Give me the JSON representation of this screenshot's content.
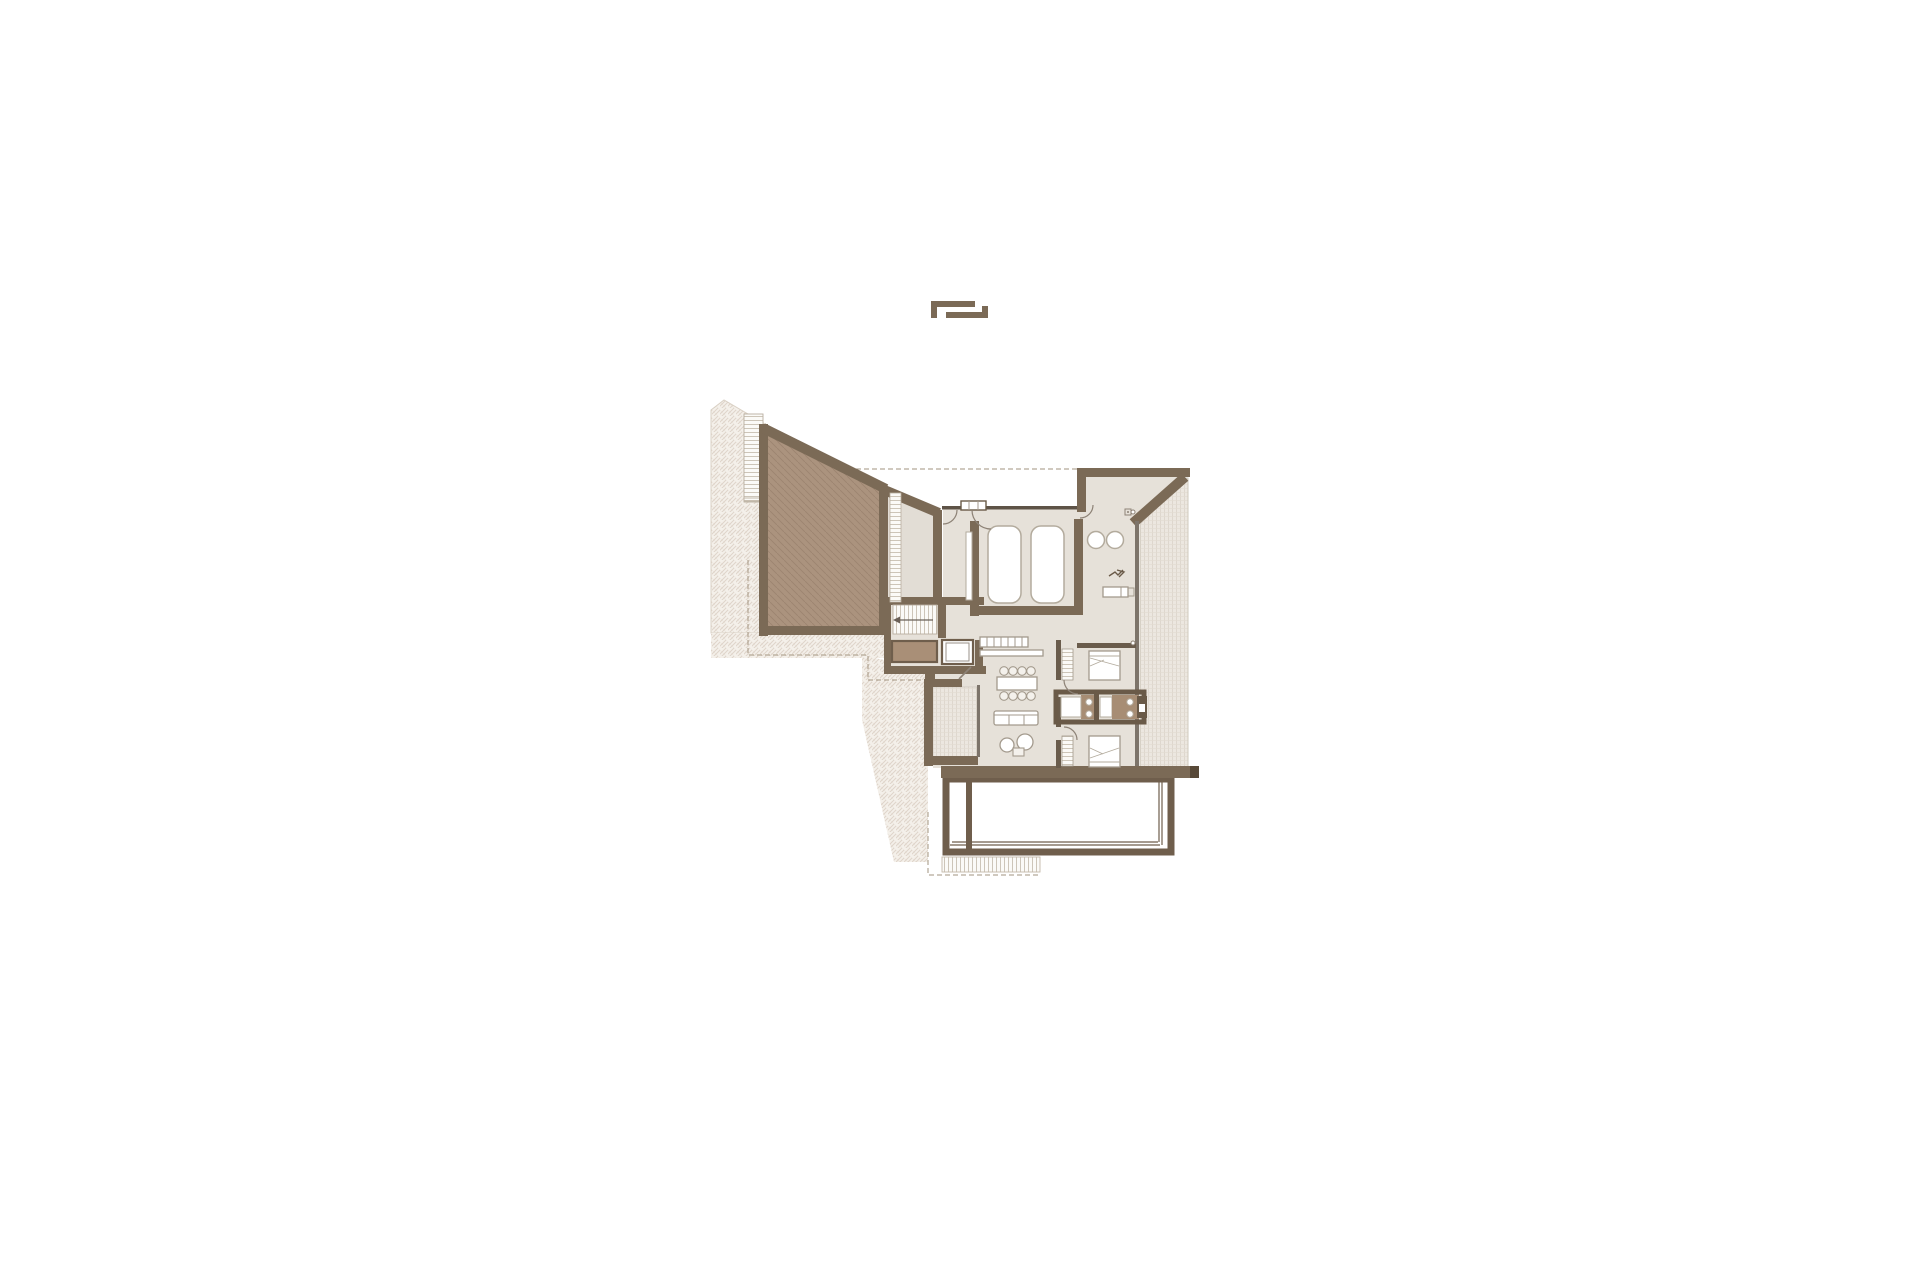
{
  "meta": {
    "type": "architectural-floor-plan",
    "description": "Upper floor plan of a house with sloped roof terraces, central staircase with elevator, twin-bed room, spa room with two basins, two bedrooms, back-to-back bathrooms, kitchen-dining-living zone, side terraces and a large lower roof terrace",
    "visible_text": []
  },
  "symbols": [
    {
      "name": "section-marker-icon",
      "meaning": "nested angle-bracket marker above the plan"
    },
    {
      "name": "stair-direction-arrow",
      "meaning": "arrow across staircase treads"
    },
    {
      "name": "floor-drain-icon",
      "meaning": "small square with dot in spa room"
    },
    {
      "name": "plant-glyph-icon",
      "meaning": "small decorative glyph in spa room"
    }
  ],
  "colors": {
    "paper": "#ffffff",
    "wall": "#7b6a56",
    "wallDark": "#5e5347",
    "wallCap": "#584938",
    "thinWall": "#6a5c4c",
    "glass": "#7d746a",
    "floor": "#e6e1d9",
    "floorAlt": "#e2ddd5",
    "roofFill": "#ab937e",
    "roofHatchLine": "rgba(122,98,78,0.28)",
    "exteriorBg": "#f4f0ea",
    "exteriorLine": "rgba(205,190,175,0.55)",
    "exteriorEdge": "#d9d0c4",
    "terraceBg": "#ece7e0",
    "terraceLine": "#d8d1c6",
    "terraceLineSoft": "#e3dcd2",
    "bottomTerraceBg": "#b09678",
    "bottomTerraceLine": "rgba(105,78,55,0.28)",
    "bottomTerraceWall": "#6f5e4c",
    "rungBg": "#fbfaf7",
    "rungLine": "#c2b8a9",
    "storage": "#a98f77",
    "vanity": "#a78d74",
    "fixtureStroke": "#b3ab9d",
    "furnitureStroke": "#a39a8d",
    "chairFill": "#f4f1ec",
    "dashLine": "#a2937f",
    "dashSoft": "#bcb2a2",
    "doorStroke": "#8d8276",
    "glyphStroke": "#6a5a48"
  }
}
